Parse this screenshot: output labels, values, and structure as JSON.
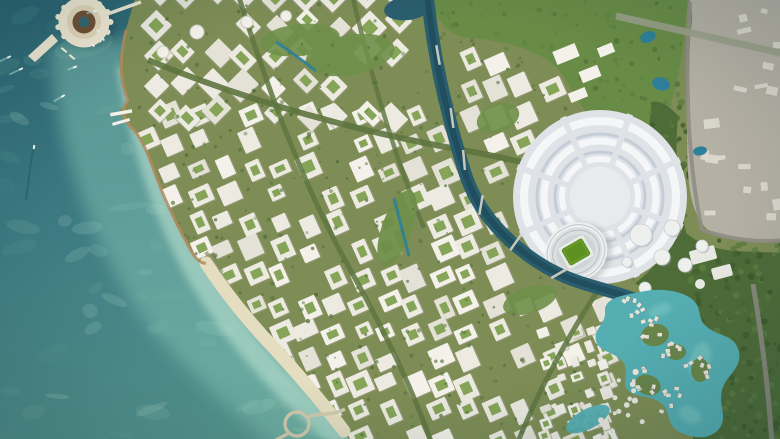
{
  "meta": {
    "width": 780,
    "height": 439,
    "kind": "aerial-masterplan-render"
  },
  "scene": {
    "description": "Aerial rendering of a coastal planned city: teal sea and turquoise shallows on the left, a ring-shaped island resort at top-left, a dense white low-rise city grid with green tree-lined streets, a dark winding canal, a circular stadium precinct with a green-pitch stadium on the right, a turquoise lagoon with villa clusters at bottom-right, a dense forest belt and a grey under-construction zone along the right edge.",
    "features": [
      {
        "name": "sea",
        "label": "Deep teal sea with boats and wakes"
      },
      {
        "name": "shallow-reef",
        "label": "Turquoise shallow water along the shore"
      },
      {
        "name": "beach",
        "label": "Sandy beach strip on the south-west coast"
      },
      {
        "name": "ring-island",
        "label": "Circular ring island resort with pier and bridge"
      },
      {
        "name": "city-grid",
        "label": "White courtyard blocks with green streets"
      },
      {
        "name": "grand-avenue",
        "label": "Tree-lined boulevards crossing the city"
      },
      {
        "name": "canal",
        "label": "Dark blue canal winding from north to the lagoon"
      },
      {
        "name": "stadium-precinct",
        "label": "Circular stadium district with concentric rings"
      },
      {
        "name": "stadium",
        "label": "Stadium with bright green pitch"
      },
      {
        "name": "lagoon",
        "label": "Turquoise lagoon with waterfront villa clusters"
      },
      {
        "name": "forest-belt",
        "label": "Dense green forest along the east edge"
      },
      {
        "name": "construction-zone",
        "label": "Grey existing construction area, top-right"
      },
      {
        "name": "ponds",
        "label": "Small blue park ponds"
      },
      {
        "name": "coastal-loop",
        "label": "Looping coastal road and pier, bottom"
      }
    ],
    "boats": [
      {
        "x": 9,
        "y": 57,
        "a": -25,
        "wake": 10
      },
      {
        "x": 21,
        "y": 69,
        "a": -25,
        "wake": 12
      },
      {
        "x": 63,
        "y": 96,
        "a": -30,
        "wake": 10
      },
      {
        "x": 34,
        "y": 147,
        "a": 100,
        "wake": 0
      },
      {
        "x": 95,
        "y": 11,
        "a": -15,
        "wake": 8
      },
      {
        "x": 75,
        "y": 67,
        "a": -20,
        "wake": 7
      },
      {
        "x": 98,
        "y": 31,
        "a": 50,
        "wake": 0
      },
      {
        "x": 103,
        "y": 39,
        "a": 50,
        "wake": 0
      },
      {
        "x": 93,
        "y": 45,
        "a": 50,
        "wake": 0
      }
    ]
  },
  "palette": {
    "sea_deep": "#2a6371",
    "sea_mid": "#3e7c83",
    "sea_light": "#58988f",
    "shallow": "#82c2b2",
    "shore_light": "#c3e7d6",
    "sand": "#e4ddc0",
    "coast_rock": "#b18a5f",
    "street_base": "#7e8d55",
    "park": "#6f8f4a",
    "courtyard": "#7fa050",
    "tree_dark": "#4b6a33",
    "forest": "#4e6c38",
    "forest_dark": "#3e5a2d",
    "block_white": "#eceae1",
    "block_alt": "#e4e2d7",
    "block_bright": "#f3f1ea",
    "block_shadow": "#9ea089",
    "canal": "#2a5d6e",
    "canal_dark": "#1d4a59",
    "lagoon": "#55aeb2",
    "lagoon_light": "#8ed0ca",
    "pond": "#2e7f9a",
    "gray_zone": "#b5b0a4",
    "gray_building": "#dcd9cf",
    "road_gray": "#8f8d84",
    "road_light": "#cfc8ad",
    "precinct": "#dfe3e8",
    "precinct_ring_light": "#f4f6f7",
    "precinct_ring_dark": "#c5cdd7",
    "stadium_white": "#eef0ee",
    "stand_gray": "#cfd5d6",
    "pitch": "#5d8f21",
    "pitch_light": "#76a833",
    "island_cream": "#efe7d2",
    "island_band": "#e2d6b8",
    "island_core": "#6e4f33",
    "island_water": "#35656e",
    "boat_white": "#f6f6f1",
    "wake": "#aeded2",
    "hall_white": "#e9e9e4",
    "avenue": "#5e7440"
  },
  "generator": {
    "seed": 42,
    "districts": [
      {
        "name": "downtown",
        "rot": -24,
        "cell": 27,
        "x0": 118,
        "y0": 34,
        "x1": 712,
        "y1": 444,
        "skip": 0.15,
        "size": 0.62
      },
      {
        "name": "north-quarter",
        "rot": 45,
        "cell": 30,
        "x0": 126,
        "y0": -6,
        "x1": 424,
        "y1": 118,
        "skip": 0.12,
        "size": 0.6
      },
      {
        "name": "south-villas",
        "rot": -20,
        "cell": 15,
        "x0": 545,
        "y0": 333,
        "x1": 648,
        "y1": 441,
        "skip": 0.25,
        "size": 0.55
      }
    ],
    "trees": 330,
    "forest_dots": 270,
    "park_dots": 90,
    "sea_patches": 46,
    "gray_buildings": 18,
    "villa_clusters": [
      [
        650,
        328
      ],
      [
        673,
        350
      ],
      [
        646,
        381
      ],
      [
        669,
        399
      ],
      [
        699,
        368
      ],
      [
        634,
        307
      ]
    ],
    "villa_circles": 16,
    "ring_pods": 13
  }
}
